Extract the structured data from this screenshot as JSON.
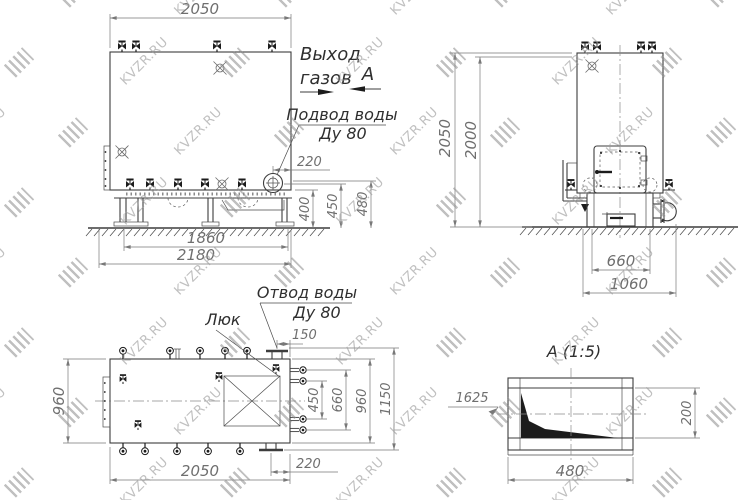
{
  "watermark": {
    "text": "KVZR.RU"
  },
  "drawing": {
    "front": {
      "dim_top": "2050",
      "dim_pipe_offset": "220",
      "dim_h1": "400",
      "dim_h2": "450",
      "dim_h3": "480",
      "dim_base_inner": "1860",
      "dim_base_outer": "2180",
      "label_gas_line1": "Выход",
      "label_gas_line2": "газов",
      "section_mark": "А",
      "label_water_in_line1": "Подвод воды",
      "label_water_in_line2": "Ду 80"
    },
    "side": {
      "dim_height_outer": "2050",
      "dim_height_inner": "2000",
      "dim_base_inner": "660",
      "dim_base_outer": "1060"
    },
    "plan": {
      "dim_left": "960",
      "dim_flange_offset": "150",
      "dim_r1": "450",
      "dim_r2": "660",
      "dim_r3": "960",
      "dim_r4": "1150",
      "dim_bottom": "2050",
      "dim_bottom_flange": "220",
      "label_water_out_line1": "Отвод воды",
      "label_water_out_line2": "Ду 80",
      "label_hatch": "Люк"
    },
    "section": {
      "title": "А  (1:5)",
      "dim_width": "480",
      "dim_height": "200",
      "note": "1625"
    }
  }
}
